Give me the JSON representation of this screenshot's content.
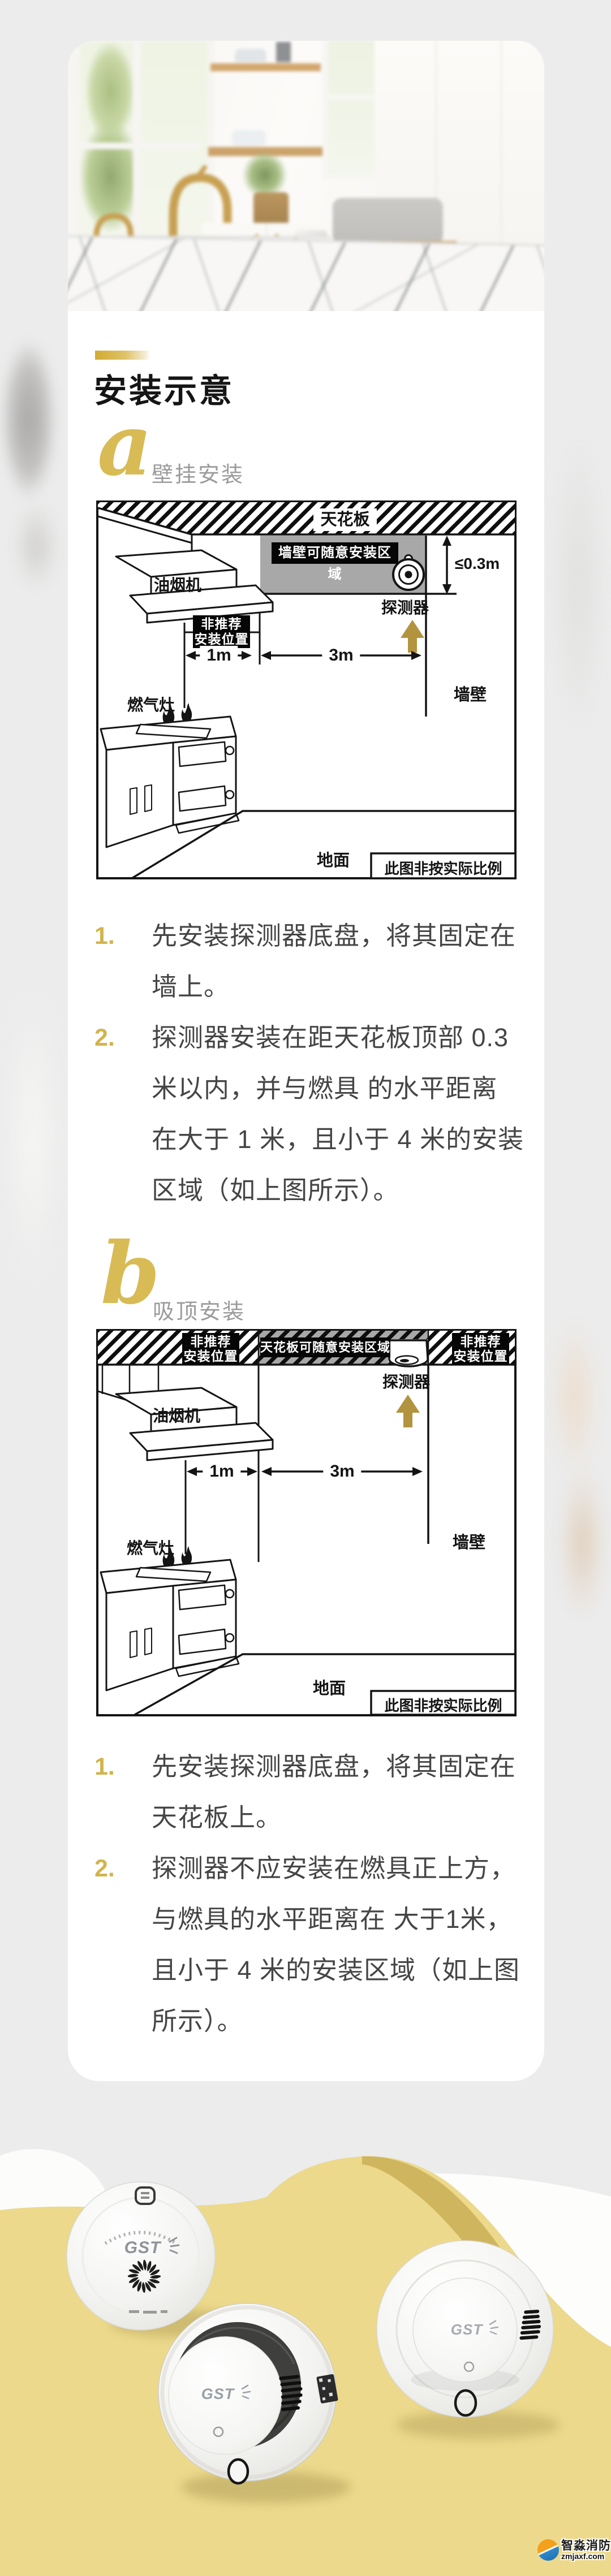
{
  "brand": {
    "name": "GST"
  },
  "header": {
    "title": "安装示意"
  },
  "sections": {
    "a": {
      "letter": "a",
      "subtitle": "壁挂安装",
      "diagram": {
        "ceiling": "天花板",
        "zone": "墙壁可随意安装区域",
        "max_dist": "≤0.3m",
        "detector": "探测器",
        "hood": "油烟机",
        "not_recommended": "非推荐\n安装位置",
        "d1": "1m",
        "d3": "3m",
        "stove": "燃气灶",
        "wall": "墙壁",
        "floor": "地面",
        "note": "此图非按实际比例"
      },
      "steps": [
        {
          "n": "1.",
          "t": "先安装探测器底盘，将其固定在\n墙上。"
        },
        {
          "n": "2.",
          "t": "探测器安装在距天花板顶部 0.3\n米以内，并与燃具 的水平距离\n在大于 1 米，且小于 4 米的安装\n区域（如上图所示）。"
        }
      ]
    },
    "b": {
      "letter": "b",
      "subtitle": "吸顶安装",
      "diagram": {
        "zone": "天花板可随意安装区域",
        "not_recommended_left": "非推荐\n安装位置",
        "not_recommended_right": "非推荐\n安装位置",
        "detector": "探测器",
        "hood": "油烟机",
        "d1": "1m",
        "d3": "3m",
        "stove": "燃气灶",
        "wall": "墙壁",
        "floor": "地面",
        "note": "此图非按实际比例"
      },
      "steps": [
        {
          "n": "1.",
          "t": "先安装探测器底盘，将其固定在\n天花板上。"
        },
        {
          "n": "2.",
          "t": "探测器不应安装在燃具正上方，\n与燃具的水平距离在 大于1米，\n且小于 4 米的安装区域（如上图\n所示）。"
        }
      ]
    }
  },
  "watermark": {
    "name": "智淼消防",
    "site": "zmjaxf.com"
  }
}
